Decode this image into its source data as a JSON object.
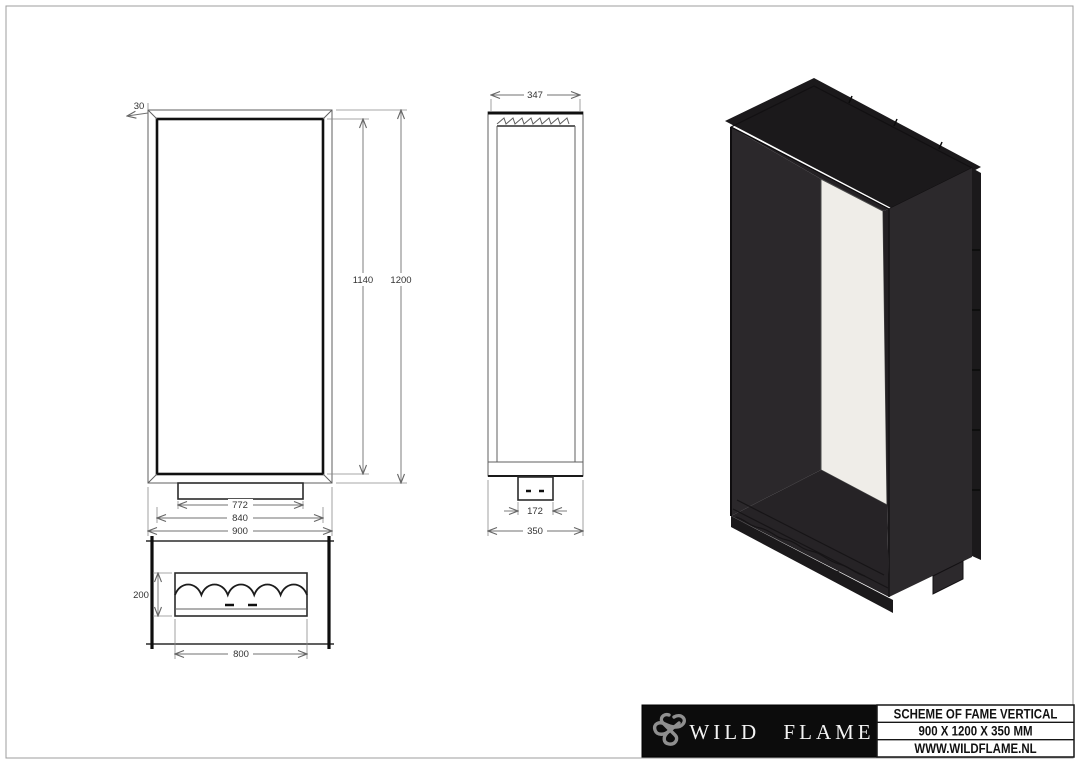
{
  "drawing": {
    "views": {
      "front": {
        "dims": {
          "flange": "30",
          "opening_height": "1140",
          "height": "1200",
          "burner_width": "772",
          "opening_width": "840",
          "width": "900"
        }
      },
      "side": {
        "dims": {
          "inner_depth": "347",
          "burner_depth": "172",
          "depth": "350"
        }
      },
      "bottom": {
        "dims": {
          "burner_depth": "200",
          "burner_length": "800"
        }
      }
    }
  },
  "title_block": {
    "brand": "WILD FLAME",
    "logo_icon": "knot-icon",
    "rows": {
      "scheme": "SCHEME OF FAME VERTICAL",
      "size": "900 X 1200 X 350 MM",
      "website": "WWW.WILDFLAME.NL"
    }
  },
  "colors": {
    "page_border": "#9c9c9c",
    "line": "#5f5f5f",
    "bold_line": "#101010",
    "titleblock_bg": "#0c0c0c",
    "brand_text": "#f3f3f3",
    "logo_gray": "#8f8f8f",
    "iso_flange": "#1b191b",
    "iso_top": "#312e31",
    "iso_right": "#2c292c",
    "iso_ceiling": "#242124",
    "iso_interior": "#2b282b",
    "iso_right_inner": "#232023",
    "iso_floor": "#262326",
    "iso_glass": "#efede8"
  }
}
